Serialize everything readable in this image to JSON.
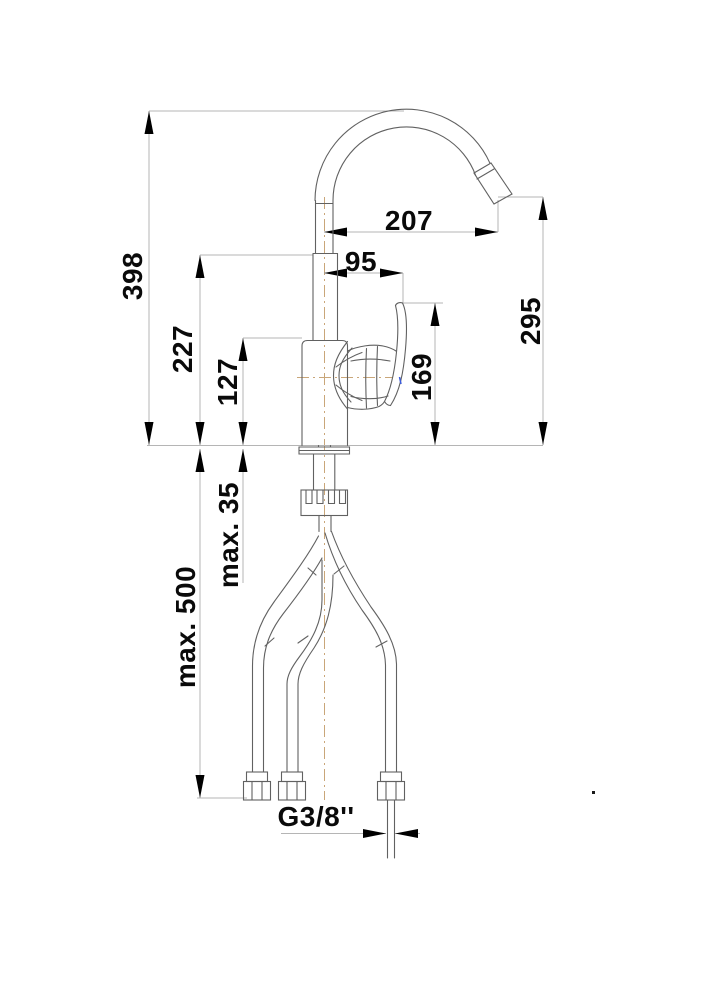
{
  "drawing": {
    "title": "faucet-dimension-drawing",
    "subject": "single-lever kitchen mixer tap with high-arc spout and three connection hoses",
    "units": "mm",
    "dimensions": {
      "height_total": "398",
      "upper_column_height": "227",
      "body_height": "127",
      "spout_reach": "207",
      "handle_reach": "95",
      "handle_top_height": "169",
      "outlet_height": "295",
      "max_deck_thickness": "max. 35",
      "max_hose_length": "max. 500",
      "connection_thread": "G3/8''"
    },
    "colors": {
      "outline": "#616161",
      "dimension_line": "#b5b5b5",
      "arrow": "#000000",
      "text": "#0a0a0a",
      "centerline": "#c9a679",
      "accent_mark": "#3b5bdb"
    }
  }
}
